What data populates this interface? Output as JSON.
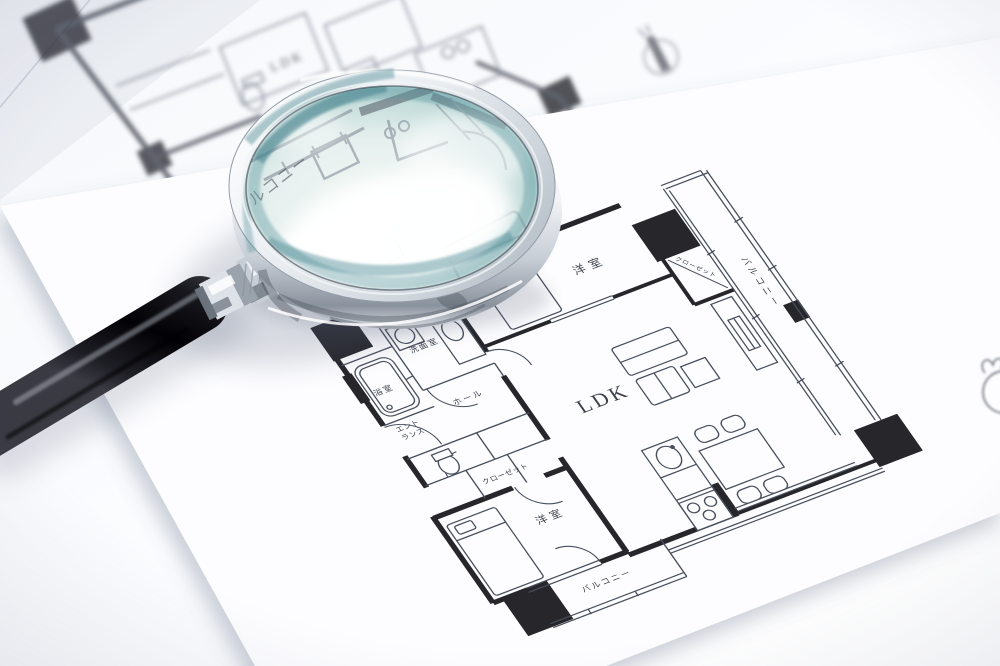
{
  "scene_title": "magnifying-glass-on-floor-plan-photo",
  "plan_labels": {
    "bedroom_top": "洋室",
    "closet_top": "クローゼット",
    "balcony_right": "バルコニー",
    "ldk": "LDK",
    "washroom": "洗面室",
    "bathroom": "浴室",
    "entrance_line1": "エント",
    "entrance_line2": "ランス",
    "hall": "ホール",
    "closet": "クローゼット",
    "bedroom_bottom": "洋室",
    "balcony_bottom": "バルコニー"
  },
  "background_plan": {
    "ldk": "LDK"
  },
  "magnified_text": {
    "balcony_partial": "ルコニー"
  },
  "colors": {
    "paper": "#fbfcfe",
    "table_shade": "#e7eaf1",
    "ink_thin": "#474e5c",
    "wall_black": "#26262b",
    "glass_teal": "#4f8b94",
    "glass_teal_light": "#8fc0c4",
    "chrome_light": "#eef1f4",
    "chrome_dark": "#848d97",
    "handle_black": "#0a0a0e"
  }
}
